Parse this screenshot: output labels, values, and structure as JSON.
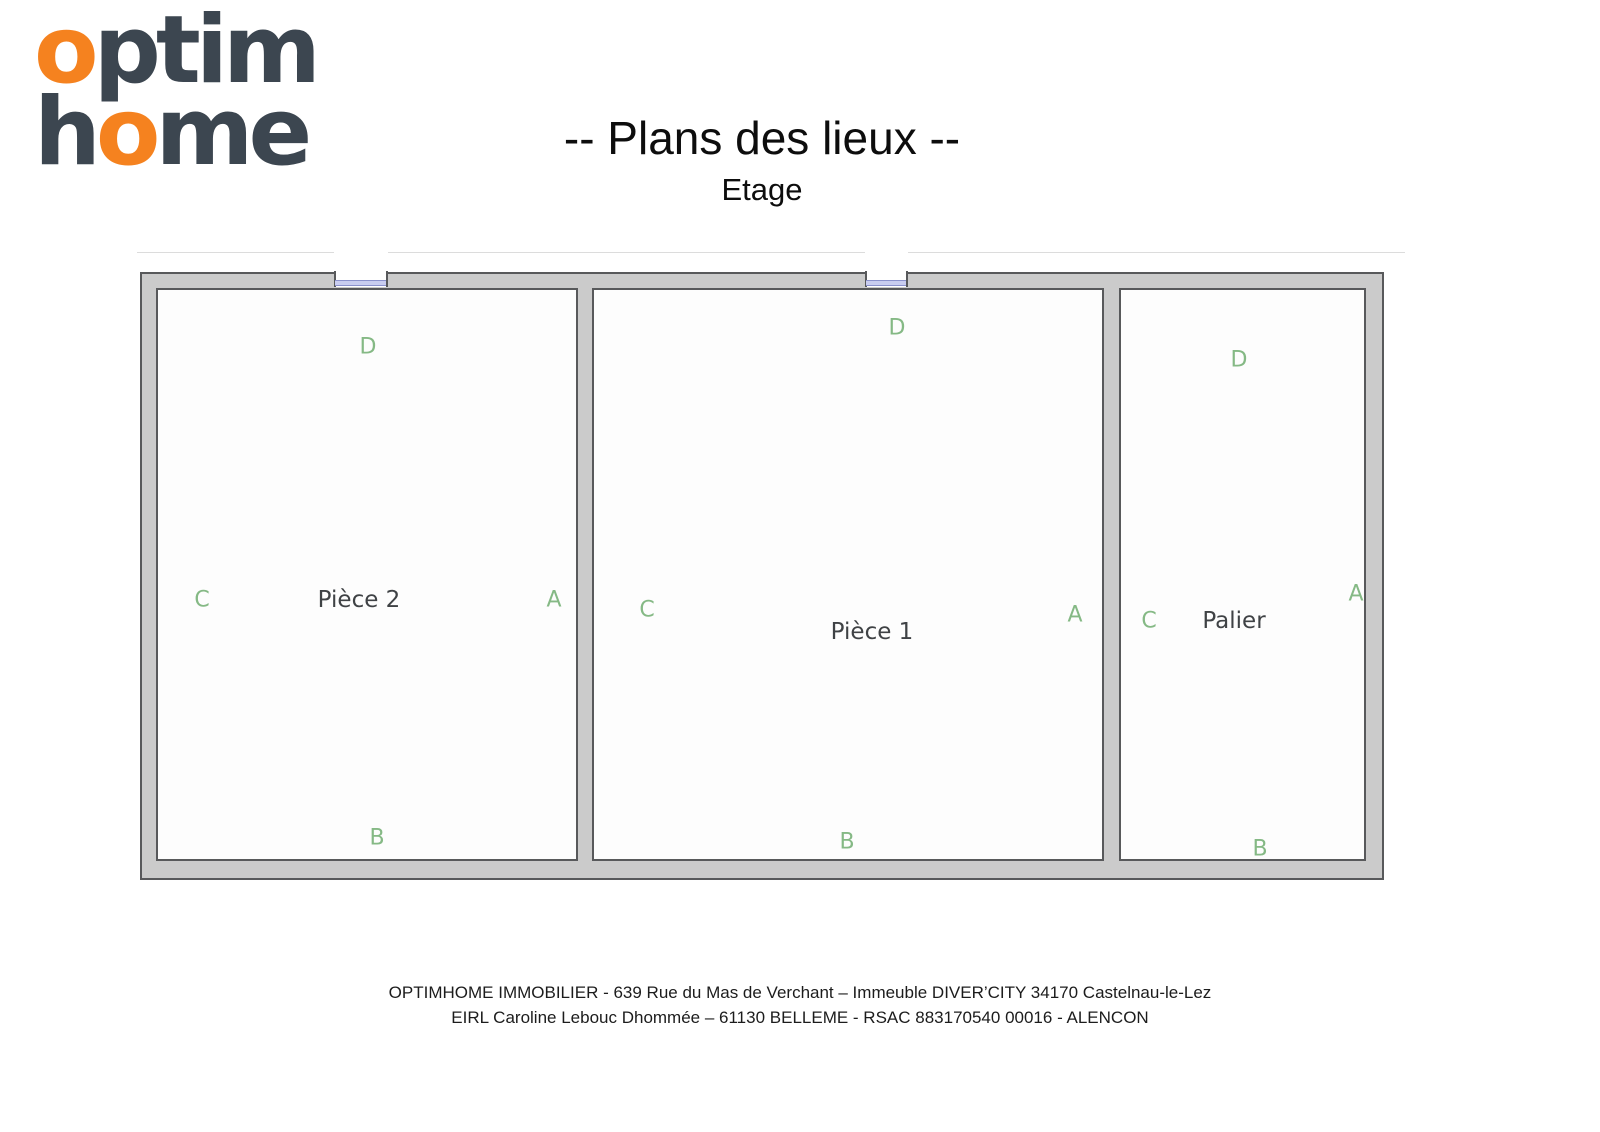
{
  "logo": {
    "line1": {
      "o": "o",
      "rest": "ptim"
    },
    "line2": {
      "h": "h",
      "o": "o",
      "rest": "me"
    },
    "orange": "#F5821F",
    "navy": "#3C4650"
  },
  "page": {
    "title": "-- Plans des lieux --",
    "subtitle": "Etage"
  },
  "plan": {
    "rooms": [
      {
        "name": "Pièce 2",
        "letter_top": "D",
        "letter_left": "C",
        "letter_right": "A",
        "letter_bottom": "B"
      },
      {
        "name": "Pièce 1",
        "letter_top": "D",
        "letter_left": "C",
        "letter_right": "A",
        "letter_bottom": "B"
      },
      {
        "name": "Palier",
        "letter_top": "D",
        "letter_left": "C",
        "letter_right": "A",
        "letter_bottom": "B"
      }
    ],
    "colors": {
      "wall_fill": "#cbcbcb",
      "wall_border": "#58595b",
      "window": "#8a91cc",
      "letter_green": "#85b985"
    }
  },
  "footer": {
    "line1": "OPTIMHOME IMMOBILIER - 639 Rue du Mas de Verchant – Immeuble DIVER’CITY 34170 Castelnau-le-Lez",
    "line2": "EIRL Caroline Lebouc Dhommée – 61130 BELLEME - RSAC 883170540 00016 - ALENCON"
  }
}
